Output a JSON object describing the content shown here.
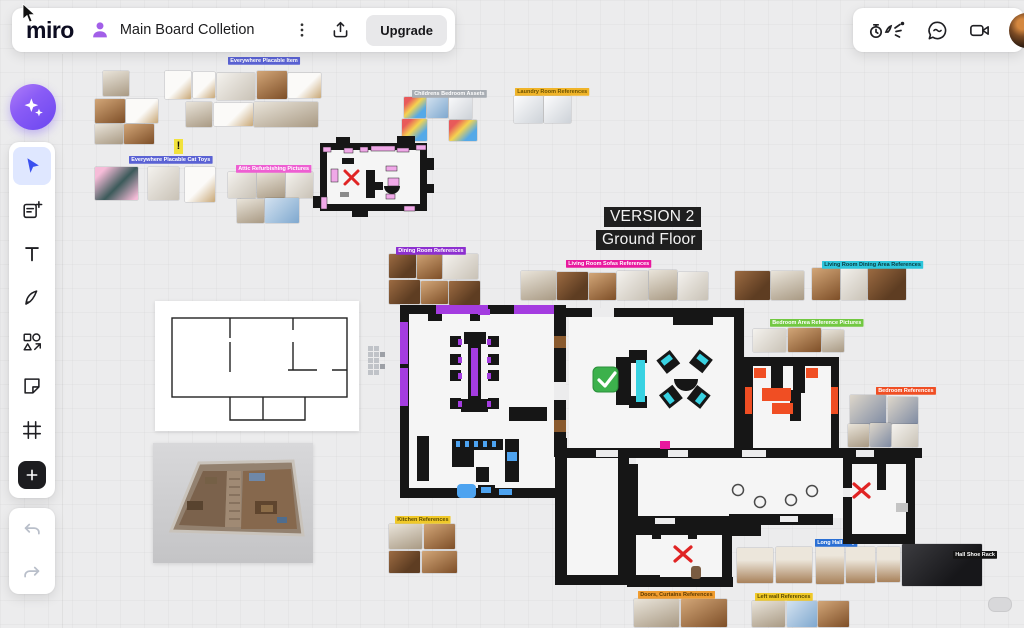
{
  "header": {
    "logo": "miro",
    "board_title": "Main Board Colletion",
    "upgrade_label": "Upgrade",
    "left_icons": [
      "user-avatar-purple",
      "kebab-menu",
      "export-share"
    ],
    "right_icons": [
      "facilitation-tools",
      "chat",
      "video-call",
      "user-avatar"
    ]
  },
  "toolbar": {
    "tools": [
      "ai-assistant",
      "select",
      "templates",
      "text",
      "pen",
      "shapes",
      "sticky-note",
      "frame",
      "add"
    ],
    "active_tool": "select",
    "history": [
      "undo",
      "redo"
    ]
  },
  "canvas": {
    "version_line1": "VERSION 2",
    "version_line2": "Ground Floor",
    "sticky_exclamation": "!",
    "tags": [
      {
        "text": "Everywhere Placable Item",
        "bg": "#5a62d4",
        "fg": "#fff",
        "x": 228,
        "y": 57
      },
      {
        "text": "Everywhere Placable Cat Toys",
        "bg": "#5a62d4",
        "fg": "#fff",
        "x": 129,
        "y": 156
      },
      {
        "text": "Attic Refurbishing Pictures",
        "bg": "#ee5fd2",
        "fg": "#fff",
        "x": 236,
        "y": 165
      },
      {
        "text": "Childrens Bedroom Assets",
        "bg": "#a8adb3",
        "fg": "#fff",
        "x": 412,
        "y": 90
      },
      {
        "text": "Laundry Room References",
        "bg": "#f0b429",
        "fg": "#6b5200",
        "x": 515,
        "y": 88
      },
      {
        "text": "Dining Room References",
        "bg": "#8d2fd0",
        "fg": "#fff",
        "x": 396,
        "y": 247
      },
      {
        "text": "Living Room Sofas References",
        "bg": "#e8199e",
        "fg": "#fff",
        "x": 566,
        "y": 260
      },
      {
        "text": "Living Room Dining Area References",
        "bg": "#2ec6dc",
        "fg": "#063a40",
        "x": 822,
        "y": 261
      },
      {
        "text": "Bedroom Area Reference Pictures",
        "bg": "#72c841",
        "fg": "#fff",
        "x": 770,
        "y": 319
      },
      {
        "text": "Bedroom References",
        "bg": "#f04e23",
        "fg": "#fff",
        "x": 876,
        "y": 387
      },
      {
        "text": "Long Hall Way",
        "bg": "#2a6fd4",
        "fg": "#fff",
        "x": 815,
        "y": 539
      },
      {
        "text": "Hall Shoe Rack",
        "bg": "#141414",
        "fg": "#fff",
        "x": 953,
        "y": 551
      },
      {
        "text": "Doors, Curtains References",
        "bg": "#f09c2e",
        "fg": "#5b3a00",
        "x": 638,
        "y": 591
      },
      {
        "text": "Left wall References",
        "bg": "#f0c929",
        "fg": "#5b4a00",
        "x": 755,
        "y": 593
      },
      {
        "text": "Kitchen References",
        "bg": "#f0c929",
        "fg": "#5b4a00",
        "x": 395,
        "y": 516
      }
    ],
    "plan_tags": [
      {
        "text": "Dining Room",
        "bg": "#1a1a1a",
        "fg": "#fff",
        "x": 417,
        "y": 349
      },
      {
        "text": "Dining Room Wiki",
        "bg": "#8d2fd0",
        "fg": "#fff",
        "x": 517,
        "y": 391
      },
      {
        "text": "Fridge",
        "bg": "#4da3f0",
        "fg": "#fff",
        "x": 415,
        "y": 444
      },
      {
        "text": "Sink",
        "bg": "#4da3f0",
        "fg": "#fff",
        "x": 415,
        "y": 468
      },
      {
        "text": "Counter",
        "bg": "#4da3f0",
        "fg": "#fff",
        "x": 466,
        "y": 454
      },
      {
        "text": "Sink",
        "bg": "#4da3f0",
        "fg": "#fff",
        "x": 459,
        "y": 486
      },
      {
        "text": "Living Room",
        "bg": "#1a1a1a",
        "fg": "#fff",
        "x": 652,
        "y": 337
      },
      {
        "text": "Elements",
        "bg": "#72c841",
        "fg": "#fff",
        "x": 688,
        "y": 313
      },
      {
        "text": "Sofa Element",
        "bg": "#2ec6dc",
        "fg": "#063a40",
        "x": 619,
        "y": 348
      },
      {
        "text": "Sofa",
        "bg": "#2ec6dc",
        "fg": "#063a40",
        "x": 621,
        "y": 373
      },
      {
        "text": "Sofa Element",
        "bg": "#2ec6dc",
        "fg": "#063a40",
        "x": 618,
        "y": 398
      },
      {
        "text": "Table",
        "bg": "#2ec6dc",
        "fg": "#063a40",
        "x": 677,
        "y": 375
      },
      {
        "text": "Living Room Dining Area",
        "bg": "#2ec6dc",
        "fg": "#063a40",
        "x": 698,
        "y": 408
      },
      {
        "text": "Bed",
        "bg": "#f04e23",
        "fg": "#fff",
        "x": 758,
        "y": 358
      },
      {
        "text": "Bed",
        "bg": "#f04e23",
        "fg": "#fff",
        "x": 800,
        "y": 358
      },
      {
        "text": "Bed",
        "bg": "#f04e23",
        "fg": "#fff",
        "x": 773,
        "y": 381
      },
      {
        "text": "Storage Chest",
        "bg": "#f04e23",
        "fg": "#fff",
        "x": 771,
        "y": 400
      },
      {
        "text": "Work Desk",
        "bg": "#f04e23",
        "fg": "#fff",
        "x": 828,
        "y": 389,
        "vertical": true
      },
      {
        "text": "Shelf",
        "bg": "#f04e23",
        "fg": "#fff",
        "x": 745,
        "y": 388,
        "vertical": true
      },
      {
        "text": "Parents Bedroom",
        "bg": "#1a1a1a",
        "fg": "#fff",
        "x": 768,
        "y": 433
      },
      {
        "text": "sizing",
        "bg": "none",
        "fg": "#fff",
        "x": 563,
        "y": 450
      },
      {
        "text": "sizing",
        "bg": "none",
        "fg": "#fff",
        "x": 683,
        "y": 450
      },
      {
        "text": "sizing",
        "bg": "none",
        "fg": "#fff",
        "x": 795,
        "y": 450
      },
      {
        "text": "Wardrobe",
        "bg": "#b5b5b5",
        "fg": "#fff",
        "x": 850,
        "y": 456
      },
      {
        "text": "Bunk Bed",
        "bg": "#b5b5b5",
        "fg": "#fff",
        "x": 881,
        "y": 476
      },
      {
        "text": "Childrens Bedroom",
        "bg": "#1a1a1a",
        "fg": "#fff",
        "x": 845,
        "y": 510
      },
      {
        "text": "Bathroom",
        "bg": "#1a1a1a",
        "fg": "#fff",
        "x": 692,
        "y": 555
      },
      {
        "text": "Sink",
        "bg": "#1faf77",
        "fg": "#fff",
        "x": 631,
        "y": 535
      },
      {
        "text": "Light Fan",
        "bg": "#1faf77",
        "fg": "#fff",
        "x": 660,
        "y": 529
      },
      {
        "text": "Shower",
        "bg": "#1faf77",
        "fg": "#fff",
        "x": 704,
        "y": 534
      },
      {
        "text": "Sink",
        "bg": "#1faf77",
        "fg": "#fff",
        "x": 652,
        "y": 564
      },
      {
        "text": "W/D",
        "bg": "#1faf77",
        "fg": "#fff",
        "x": 671,
        "y": 564
      },
      {
        "text": "Kitchen/Dining area",
        "bg": "none",
        "fg": "#b3b3b3",
        "x": 183,
        "y": 359
      },
      {
        "text": "Living room",
        "bg": "none",
        "fg": "#b3b3b3",
        "x": 243,
        "y": 343
      },
      {
        "text": "Bedroom",
        "bg": "none",
        "fg": "#b3b3b3",
        "x": 299,
        "y": 344
      },
      {
        "text": "Hallway",
        "bg": "none",
        "fg": "#b3b3b3",
        "x": 240,
        "y": 396
      },
      {
        "text": "Bathroom",
        "bg": "none",
        "fg": "#b3b3b3",
        "x": 275,
        "y": 405
      }
    ],
    "photo_clusters": [
      {
        "name": "cat-shelves-a",
        "photos": [
          [
            103,
            71,
            26,
            25,
            "int2"
          ],
          [
            95,
            99,
            30,
            24,
            "wood2"
          ],
          [
            126,
            99,
            32,
            24,
            "shelf"
          ],
          [
            95,
            124,
            28,
            20,
            "int2"
          ],
          [
            124,
            124,
            30,
            20,
            "wood2"
          ]
        ]
      },
      {
        "name": "cat-shelves-b",
        "photos": [
          [
            165,
            71,
            26,
            28,
            "shelf"
          ],
          [
            193,
            72,
            22,
            26,
            "shelf"
          ],
          [
            217,
            73,
            38,
            27,
            "int"
          ],
          [
            257,
            71,
            30,
            28,
            "wood2"
          ],
          [
            288,
            73,
            33,
            25,
            "shelf"
          ],
          [
            186,
            102,
            26,
            25,
            "int2"
          ],
          [
            214,
            103,
            39,
            23,
            "shelf"
          ],
          [
            254,
            102,
            64,
            25,
            "int2"
          ]
        ]
      },
      {
        "name": "cat-toys",
        "photos": [
          [
            95,
            167,
            43,
            33,
            "cat"
          ],
          [
            148,
            167,
            31,
            33,
            "int"
          ],
          [
            185,
            167,
            30,
            35,
            "shelf"
          ]
        ]
      },
      {
        "name": "refurbishing",
        "photos": [
          [
            228,
            172,
            28,
            26,
            "int"
          ],
          [
            257,
            172,
            28,
            26,
            "int2"
          ],
          [
            286,
            172,
            27,
            26,
            "int"
          ],
          [
            237,
            199,
            27,
            24,
            "int2"
          ],
          [
            265,
            198,
            34,
            25,
            "blue"
          ]
        ]
      },
      {
        "name": "kids-toys",
        "photos": [
          [
            404,
            97,
            22,
            21,
            "toys"
          ],
          [
            427,
            96,
            21,
            22,
            "blue"
          ],
          [
            449,
            94,
            23,
            25,
            "app"
          ],
          [
            402,
            119,
            25,
            22,
            "toys"
          ],
          [
            449,
            120,
            28,
            21,
            "toys"
          ]
        ]
      },
      {
        "name": "laundry",
        "photos": [
          [
            514,
            96,
            29,
            27,
            "app"
          ],
          [
            544,
            96,
            27,
            27,
            "app"
          ]
        ]
      },
      {
        "name": "dining-refs",
        "photos": [
          [
            389,
            254,
            27,
            24,
            "wood"
          ],
          [
            417,
            252,
            25,
            27,
            "wood2"
          ],
          [
            443,
            254,
            35,
            25,
            "int"
          ],
          [
            389,
            280,
            31,
            24,
            "wood"
          ],
          [
            421,
            281,
            27,
            23,
            "wood2"
          ],
          [
            449,
            281,
            31,
            24,
            "wood"
          ]
        ]
      },
      {
        "name": "sofa-refs",
        "photos": [
          [
            521,
            271,
            35,
            29,
            "int2"
          ],
          [
            557,
            272,
            31,
            28,
            "wood"
          ],
          [
            589,
            273,
            27,
            27,
            "wood2"
          ],
          [
            617,
            271,
            31,
            29,
            "int"
          ],
          [
            649,
            270,
            28,
            30,
            "int2"
          ],
          [
            678,
            272,
            30,
            28,
            "int"
          ]
        ]
      },
      {
        "name": "tv-refs",
        "photos": [
          [
            735,
            271,
            35,
            29,
            "wood"
          ],
          [
            771,
            271,
            33,
            29,
            "int2"
          ]
        ]
      },
      {
        "name": "dining-area-refs",
        "photos": [
          [
            812,
            268,
            28,
            32,
            "wood2"
          ],
          [
            841,
            266,
            26,
            34,
            "int"
          ],
          [
            868,
            268,
            38,
            32,
            "wood"
          ]
        ]
      },
      {
        "name": "bedroom-area-refs",
        "photos": [
          [
            753,
            329,
            33,
            23,
            "int"
          ],
          [
            788,
            328,
            33,
            24,
            "wood2"
          ],
          [
            822,
            330,
            22,
            22,
            "int2"
          ]
        ]
      },
      {
        "name": "bedroom-refs",
        "photos": [
          [
            850,
            395,
            36,
            29,
            "bed"
          ],
          [
            888,
            397,
            30,
            27,
            "bed"
          ],
          [
            848,
            424,
            21,
            23,
            "int2"
          ],
          [
            870,
            423,
            21,
            24,
            "bed"
          ],
          [
            892,
            424,
            26,
            23,
            "int"
          ]
        ]
      },
      {
        "name": "kitchen-refs",
        "photos": [
          [
            389,
            524,
            33,
            25,
            "int2"
          ],
          [
            424,
            524,
            31,
            25,
            "wood2"
          ],
          [
            389,
            551,
            31,
            22,
            "wood"
          ],
          [
            422,
            551,
            35,
            22,
            "wood2"
          ]
        ]
      },
      {
        "name": "hall-refs",
        "photos": [
          [
            737,
            548,
            36,
            35,
            "hall"
          ],
          [
            776,
            547,
            36,
            36,
            "hall"
          ],
          [
            816,
            540,
            28,
            44,
            "hall"
          ],
          [
            846,
            547,
            29,
            36,
            "hall"
          ],
          [
            877,
            547,
            23,
            35,
            "hall"
          ]
        ]
      },
      {
        "name": "shoe-rack",
        "photos": [
          [
            902,
            544,
            80,
            42,
            "dark"
          ]
        ]
      },
      {
        "name": "doors-refs",
        "photos": [
          [
            634,
            599,
            45,
            28,
            "int2"
          ],
          [
            681,
            599,
            46,
            28,
            "wood2"
          ]
        ]
      },
      {
        "name": "leftwall-refs",
        "photos": [
          [
            752,
            601,
            33,
            26,
            "int2"
          ],
          [
            787,
            601,
            30,
            26,
            "blue"
          ],
          [
            818,
            601,
            31,
            26,
            "wood2"
          ]
        ]
      }
    ]
  }
}
